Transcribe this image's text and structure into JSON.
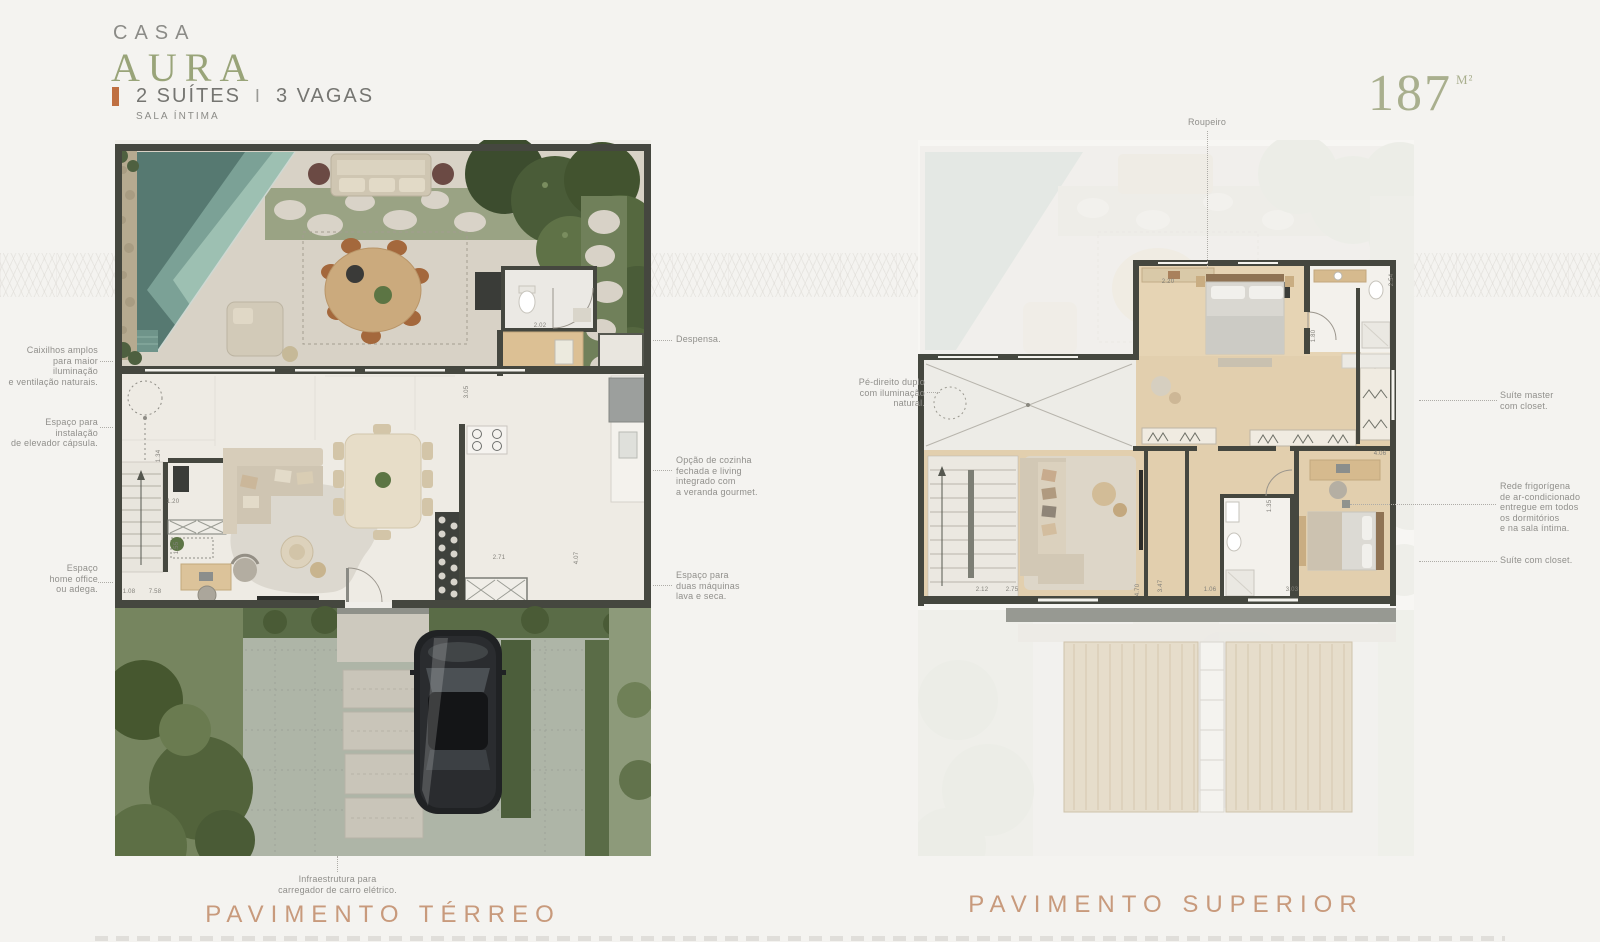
{
  "header": {
    "brand_top": "CASA",
    "brand_name": "AURA",
    "spec_suites": "2 SUÍTES",
    "spec_divider": "I",
    "spec_vagas": "3 VAGAS",
    "spec_sub": "SALA ÍNTIMA",
    "area_value": "187",
    "area_unit": "M²"
  },
  "captions": {
    "terreo": "PAVIMENTO TÉRREO",
    "superior": "PAVIMENTO SUPERIOR"
  },
  "annotations": {
    "caixilhos": "Caixilhos amplos\npara maior iluminação\ne ventilação naturais.",
    "elevador": "Espaço para instalação\nde elevador cápsula.",
    "home_office": "Espaço\nhome office\nou adega.",
    "despensa": "Despensa.",
    "cozinha": "Opção de cozinha\nfechada e living\nintegrado com\na veranda gourmet.",
    "lava_seca": "Espaço para\nduas máquinas\nlava e seca.",
    "carregador": "Infraestrutura para\ncarregador de carro elétrico.",
    "pe_direito": "Pé-direito duplo\ncom iluminação\nnatural.",
    "roupeiro": "Roupeiro",
    "suite_master": "Suíte master\ncom closet.",
    "rede_frigorigena": "Rede frigorígena\nde ar-condicionado\nentregue em todos\nos dormitórios\ne na sala íntima.",
    "suite_closet": "Suíte com closet."
  },
  "plans": {
    "terreo": {
      "dimensions": [
        {
          "t": "2.02",
          "x": 425,
          "y": 186
        },
        {
          "t": "3.05",
          "x": 352,
          "y": 252,
          "v": 1
        },
        {
          "t": "2.71",
          "x": 384,
          "y": 418
        },
        {
          "t": "4.07",
          "x": 462,
          "y": 418,
          "v": 1
        },
        {
          "t": "1.34",
          "x": 44,
          "y": 316,
          "v": 1
        },
        {
          "t": "1.20",
          "x": 58,
          "y": 362
        },
        {
          "t": "1.55",
          "x": 62,
          "y": 408,
          "v": 1
        },
        {
          "t": "1.08",
          "x": 14,
          "y": 452
        },
        {
          "t": "7.58",
          "x": 40,
          "y": 452
        }
      ]
    },
    "superior": {
      "dimensions": [
        {
          "t": "2.20",
          "x": 250,
          "y": 142
        },
        {
          "t": "2.54",
          "x": 474,
          "y": 140,
          "v": 1
        },
        {
          "t": "1.80",
          "x": 396,
          "y": 196,
          "v": 1
        },
        {
          "t": "4.06",
          "x": 462,
          "y": 314
        },
        {
          "t": "2.12",
          "x": 64,
          "y": 450
        },
        {
          "t": "2.75",
          "x": 94,
          "y": 450
        },
        {
          "t": "4.70",
          "x": 220,
          "y": 450,
          "v": 1
        },
        {
          "t": "3.47",
          "x": 243,
          "y": 446,
          "v": 1
        },
        {
          "t": "1.06",
          "x": 292,
          "y": 450
        },
        {
          "t": "3.03",
          "x": 374,
          "y": 450
        },
        {
          "t": "1.35",
          "x": 352,
          "y": 366,
          "v": 1
        }
      ]
    }
  },
  "palette": {
    "accent_orange": "#bf6f41",
    "brand_olive": "#99a479",
    "caption_terracotta": "#c89a7c",
    "annotation_gray": "#908f8b",
    "pool_teal": "#5d7f77",
    "wall_dark": "#45473f"
  }
}
